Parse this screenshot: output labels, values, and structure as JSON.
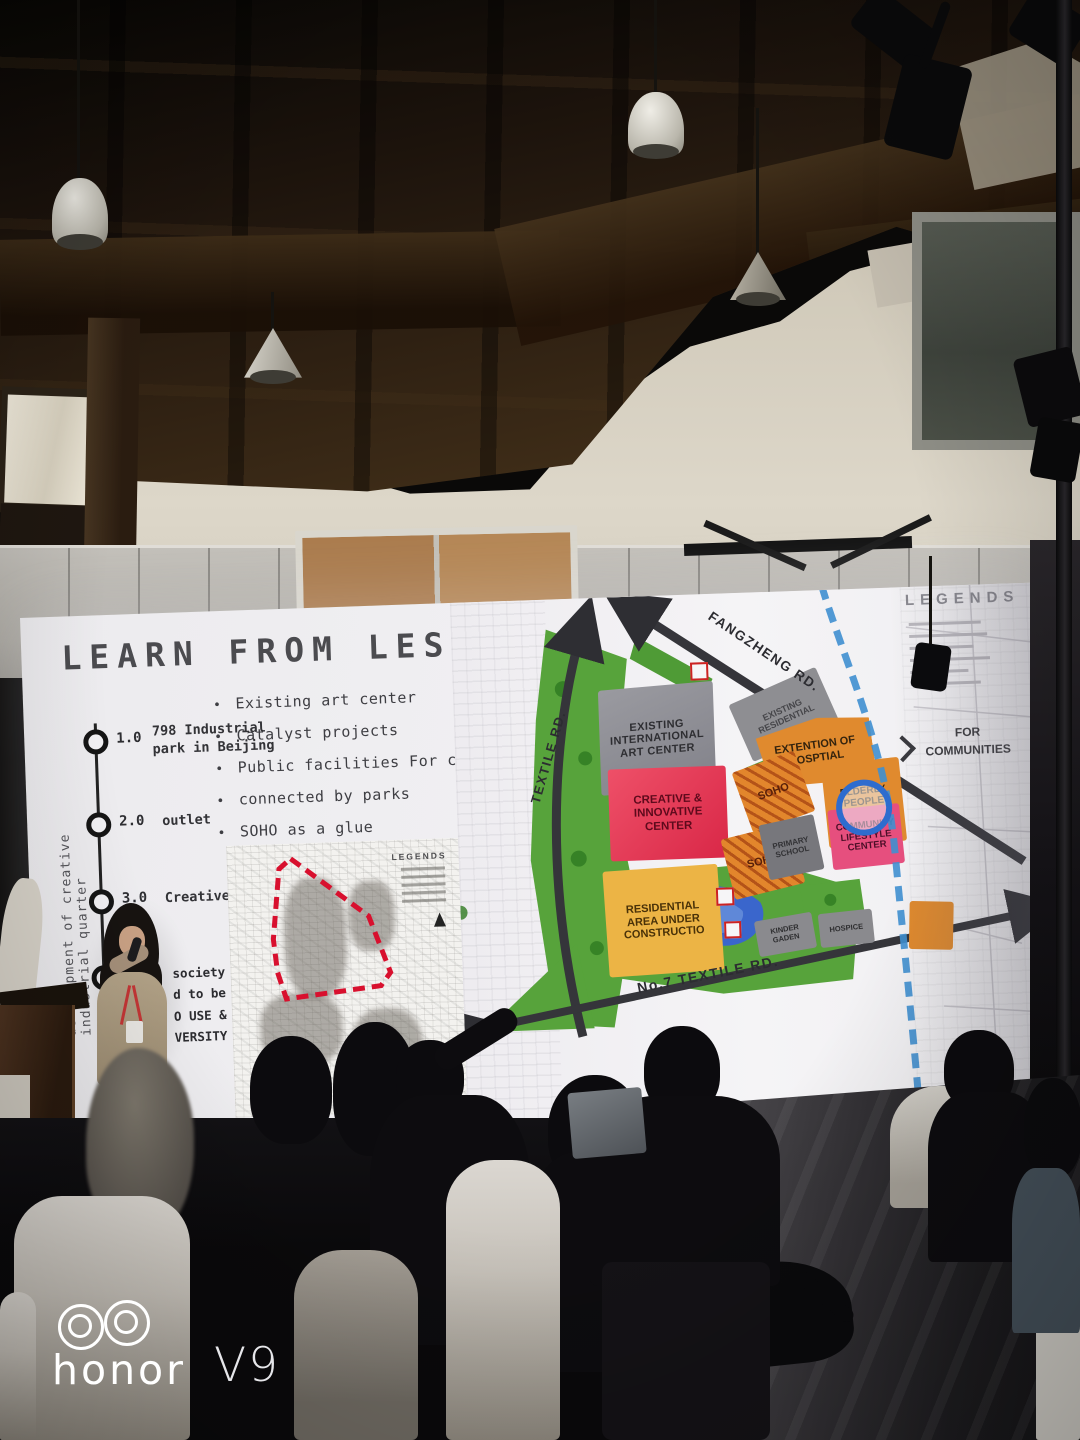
{
  "watermark": {
    "brand": "honor",
    "model": "V9"
  },
  "slide": {
    "title": "LEARN FROM LESSONS",
    "timeline": {
      "axis_label": "development of creative industrial quarter",
      "milestones": [
        {
          "num": "1.0",
          "label": "798 Industrial\npark in Beijing"
        },
        {
          "num": "2.0",
          "label": "outlet"
        },
        {
          "num": "3.0",
          "label": "Creative center"
        },
        {
          "num": "",
          "label": "society\nd to be\nO USE &\nVERSITY"
        }
      ]
    },
    "bullets": [
      "Existing art center",
      "Catalyst projects",
      "Public facilities For community",
      "connected by parks",
      "SOHO as a glue"
    ],
    "inset_map": {
      "legend_title": "LEGENDS"
    },
    "map": {
      "legend_title": "LEGENDS",
      "roads": {
        "fangzheng": "FANGZHENG RD.",
        "textile": "TEXTILE RD.",
        "no7_textile": "No.7 TEXTILE RD."
      },
      "areas": {
        "existing_international": "EXISTING\nINTERNATIONAL\nART CENTER",
        "existing_residential": "EXISTING\nRESIDENTIAL",
        "extention_of_hosptial": "EXTENTION OF\nHOSPTIAL",
        "elderly_people_home": "ELDERLY\nPEOPLE\nHOME",
        "creative_innovative": "CREATIVE &\nINNOVATIVE\nCENTER",
        "soho": "SOHO",
        "community_lifestyle": "COMMUNITY\nLIFESTYLE\nCENTER",
        "primary_school": "PRIMARY\nSCHOOL",
        "residential_construction": "RESIDENTIAL\nAREA UNDER\nCONSTRUCTIO",
        "kinder_gaden": "KINDER\nGADEN",
        "hospice": "HOSPICE"
      },
      "annotations": {
        "for_communities": "FOR\nCOMMUNITIES"
      }
    },
    "colors": {
      "map_red": "#e5445e",
      "map_orange": "#e08a2e",
      "map_yellow": "#ecb445",
      "map_green": "#57a33b",
      "map_gray": "#8c8c90",
      "map_pink": "#e64f7e",
      "pond_blue": "#3a66cc",
      "canal_blue": "#3f8fd0"
    }
  }
}
